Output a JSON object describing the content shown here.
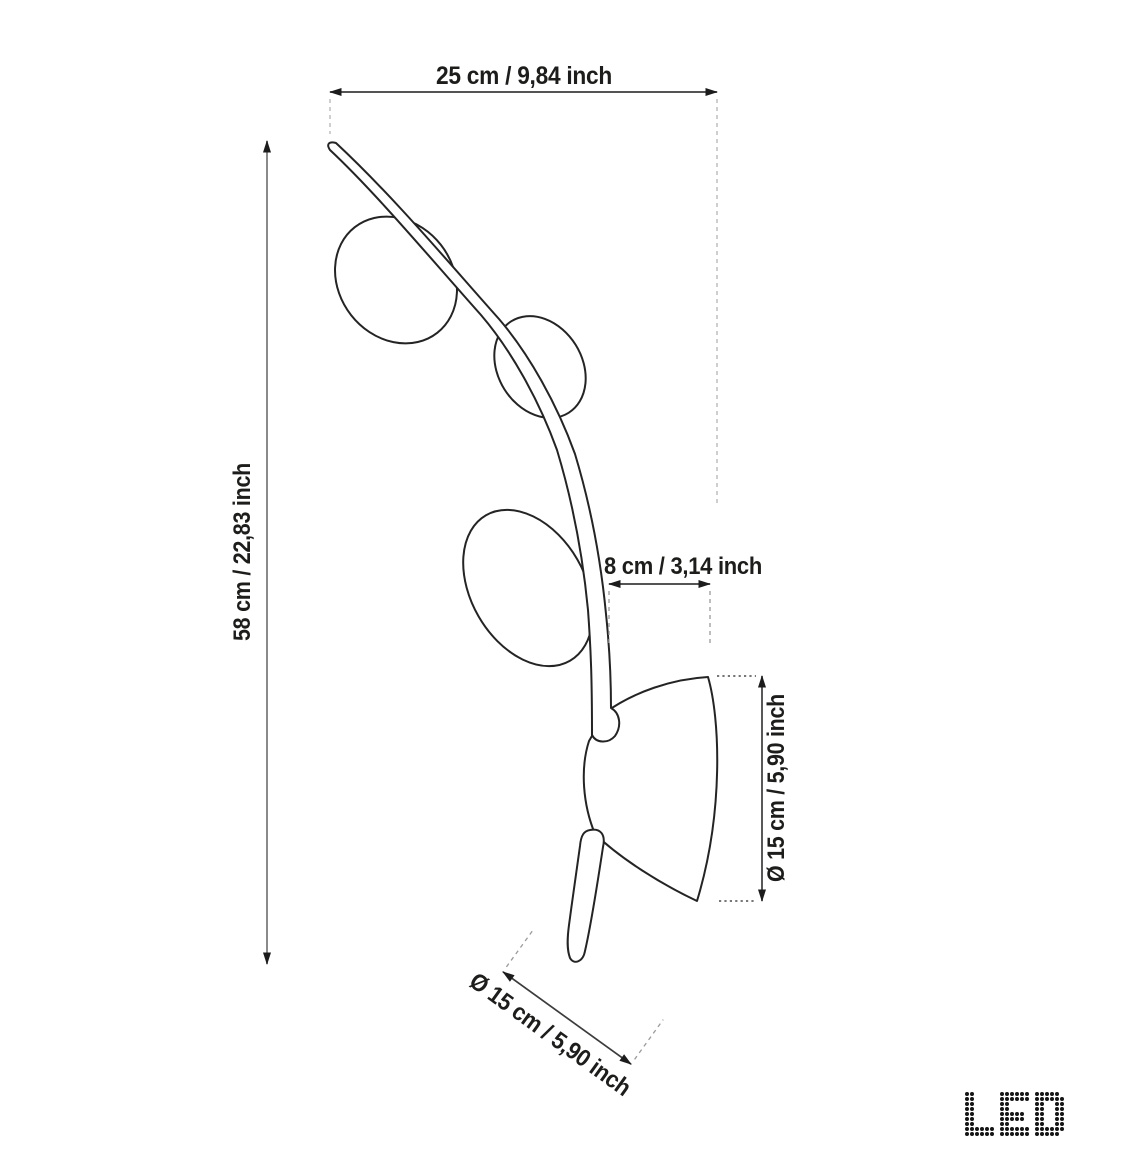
{
  "dimensions": {
    "width_top": "25 cm / 9,84 inch",
    "height_left": "58 cm / 22,83 inch",
    "offset_middle": "8 cm / 3,14 inch",
    "diameter_right": "Ø 15 cm / 5,90 inch",
    "diameter_bottom": "Ø 15 cm / 5,90 inch"
  },
  "colors": {
    "background": "#ffffff",
    "lamp_outline": "#242424",
    "dimension_line": "#3c3c3c",
    "dimension_line_secondary": "#8a8a8a",
    "arrowhead": "#1c1c1c",
    "extension_dashed": "#b5b5b5",
    "extension_dotted": "#4a4a4a",
    "label_text": "#1d1d1b",
    "led_dot": "#151515"
  },
  "led_logo": {
    "label": "LED",
    "rows": [
      "##.....######.#####.",
      "##.....######.######",
      "##.....##.....##..##",
      "##.....##.....##..##",
      "##.....#####..##..##",
      "##.....#####..##..##",
      "##.....##.....##..##",
      "######.######.######",
      "######.######.#####."
    ]
  }
}
